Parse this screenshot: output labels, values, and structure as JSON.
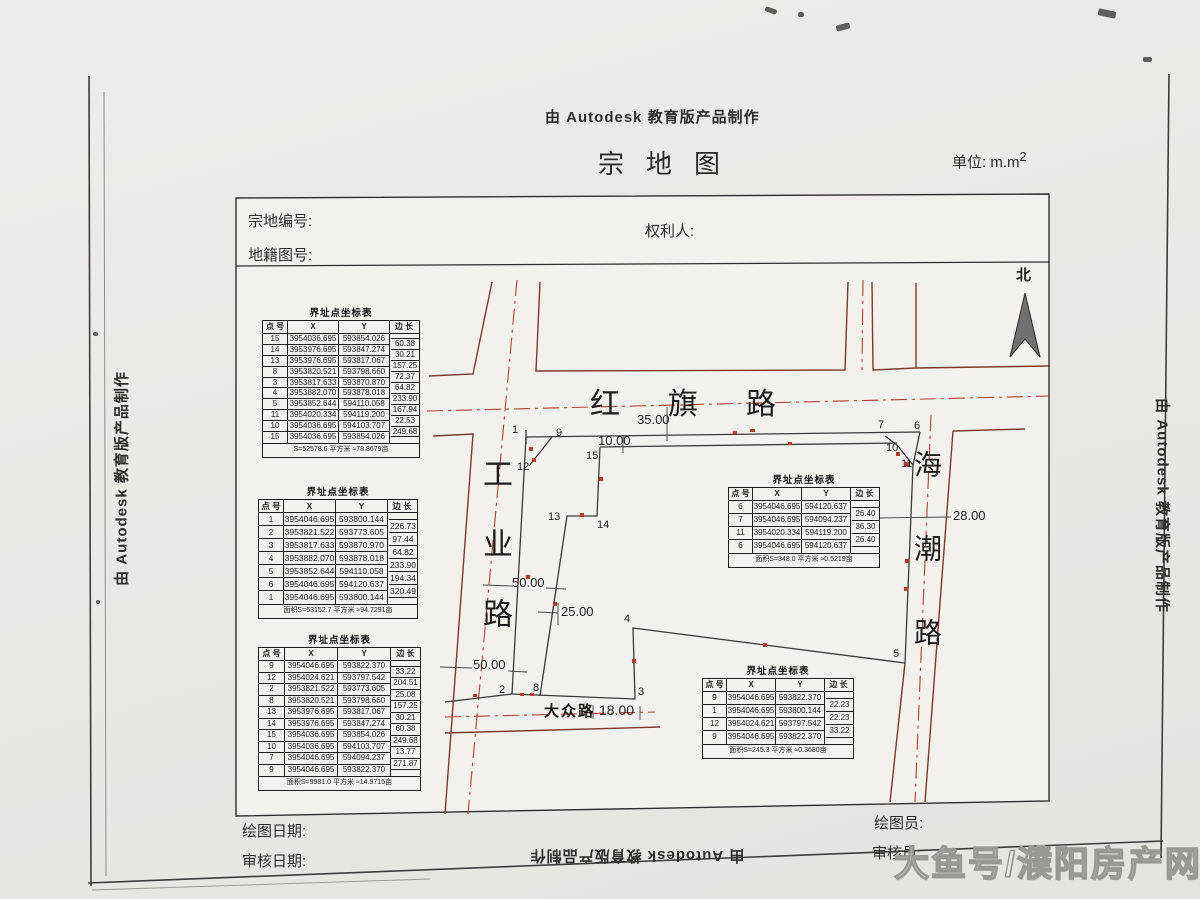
{
  "page": {
    "top_stamp": "由 Autodesk 教育版产品制作",
    "title": "宗地图",
    "unit": "单位: m.m",
    "unit_sup": "2",
    "left_stamp": "由 Autodesk 教育版产品制作",
    "right_stamp": "由 Autodesk 教育版产品制作",
    "bottom_stamp": "由 Autodesk 教育版产品制作",
    "watermark": "大鱼号/濮阳房产网"
  },
  "header": {
    "parcel_no_label": "宗地编号:",
    "sheet_no_label": "地籍图号:",
    "owner_label": "权利人:"
  },
  "footer": {
    "draw_date_label": "绘图日期:",
    "review_date_label": "审核日期:",
    "drafter_label": "绘图员:",
    "reviewer_label": "审核员:"
  },
  "map": {
    "north_label": "北",
    "roads": {
      "hongqi": "红旗路",
      "gongye": "工业路",
      "haichao": "海潮路",
      "dazhong": "大众路"
    },
    "dims": {
      "d35": "35.00",
      "d10": "10.00",
      "d50a": "50.00",
      "d25": "25.00",
      "d50b": "50.00",
      "d28": "28.00",
      "d18": "18.00"
    },
    "points": {
      "p1": "1",
      "p2": "2",
      "p3": "3",
      "p4": "4",
      "p5": "5",
      "p6": "6",
      "p7": "7",
      "p8": "8",
      "p9": "9",
      "p10": "10",
      "p11": "11",
      "p12": "12",
      "p13": "13",
      "p14": "14",
      "p15": "15"
    }
  },
  "tables": [
    {
      "title": "界址点坐标表",
      "headers": [
        "点 号",
        "X",
        "Y",
        "边 长"
      ],
      "rows": [
        [
          "15",
          "3954036.695",
          "593854.026"
        ],
        [
          "14",
          "3953976.695",
          "593847.274"
        ],
        [
          "13",
          "3953976.695",
          "593817.067"
        ],
        [
          "8",
          "3953820.521",
          "593798.660"
        ],
        [
          "3",
          "3953817.633",
          "593870.870"
        ],
        [
          "4",
          "3953882.070",
          "593878.018"
        ],
        [
          "5",
          "3953852.644",
          "594110.058"
        ],
        [
          "11",
          "3954020.334",
          "594119.200"
        ],
        [
          "10",
          "3954036.695",
          "594103.707"
        ],
        [
          "15",
          "3954036.695",
          "593854.026"
        ]
      ],
      "edges": [
        "60.38",
        "30.21",
        "157.25",
        "72.37",
        "64.82",
        "233.90",
        "167.94",
        "22.53",
        "249.68"
      ],
      "footer": "S=52578.6 平方米 ≈78.8679亩"
    },
    {
      "title": "界址点坐标表",
      "headers": [
        "点 号",
        "X",
        "Y",
        "边 长"
      ],
      "rows": [
        [
          "1",
          "3954046.695",
          "593800.144"
        ],
        [
          "2",
          "3953821.522",
          "593773.605"
        ],
        [
          "3",
          "3953817.633",
          "593870.970"
        ],
        [
          "4",
          "3953882.070",
          "593878.018"
        ],
        [
          "5",
          "3953852.644",
          "594110.058"
        ],
        [
          "6",
          "3954046.695",
          "594120.637"
        ],
        [
          "1",
          "3954046.695",
          "593800.144"
        ]
      ],
      "edges": [
        "226.73",
        "97.44",
        "64.82",
        "233.90",
        "194.34",
        "320.49"
      ],
      "footer": "面积S=63152.7 平方米 ≈94.7291亩"
    },
    {
      "title": "界址点坐标表",
      "headers": [
        "点 号",
        "X",
        "Y",
        "边 长"
      ],
      "rows": [
        [
          "9",
          "3954046.695",
          "593822.370"
        ],
        [
          "12",
          "3954024.621",
          "593797.542"
        ],
        [
          "2",
          "3953821.522",
          "593773.605"
        ],
        [
          "8",
          "3953820.521",
          "593798.660"
        ],
        [
          "13",
          "3953976.695",
          "593817.067"
        ],
        [
          "14",
          "3953976.695",
          "593847.274"
        ],
        [
          "15",
          "3954036.695",
          "593854.026"
        ],
        [
          "10",
          "3954036.695",
          "594103.707"
        ],
        [
          "7",
          "3954046.695",
          "594094.237"
        ],
        [
          "9",
          "3954046.695",
          "593822.370"
        ]
      ],
      "edges": [
        "33.22",
        "204.51",
        "25.08",
        "157.25",
        "30.21",
        "60.38",
        "249.68",
        "13.77",
        "271.87"
      ],
      "footer": "面积S=9981.0 平方米 ≈14.9715亩"
    },
    {
      "title": "界址点坐标表",
      "headers": [
        "点 号",
        "X",
        "Y",
        "边 长"
      ],
      "rows": [
        [
          "6",
          "3954046.695",
          "594120.637"
        ],
        [
          "7",
          "3954046.695",
          "594094.237"
        ],
        [
          "11",
          "3954020.334",
          "594119.200"
        ],
        [
          "6",
          "3954046.695",
          "594120.637"
        ]
      ],
      "edges": [
        "26.40",
        "36.30",
        "26.40"
      ],
      "footer": "面积S=348.0 平方米 ≈0.5219亩"
    },
    {
      "title": "界址点坐标表",
      "headers": [
        "点 号",
        "X",
        "Y",
        "边 长"
      ],
      "rows": [
        [
          "9",
          "3954046.695",
          "593822.370"
        ],
        [
          "1",
          "3954046.695",
          "593800.144"
        ],
        [
          "12",
          "3954024.621",
          "593797.542"
        ],
        [
          "9",
          "3954046.695",
          "593822.370"
        ]
      ],
      "edges": [
        "22.23",
        "22.23",
        "33.22"
      ],
      "footer": "面积S=245.3 平方米 ≈0.3680亩"
    }
  ]
}
